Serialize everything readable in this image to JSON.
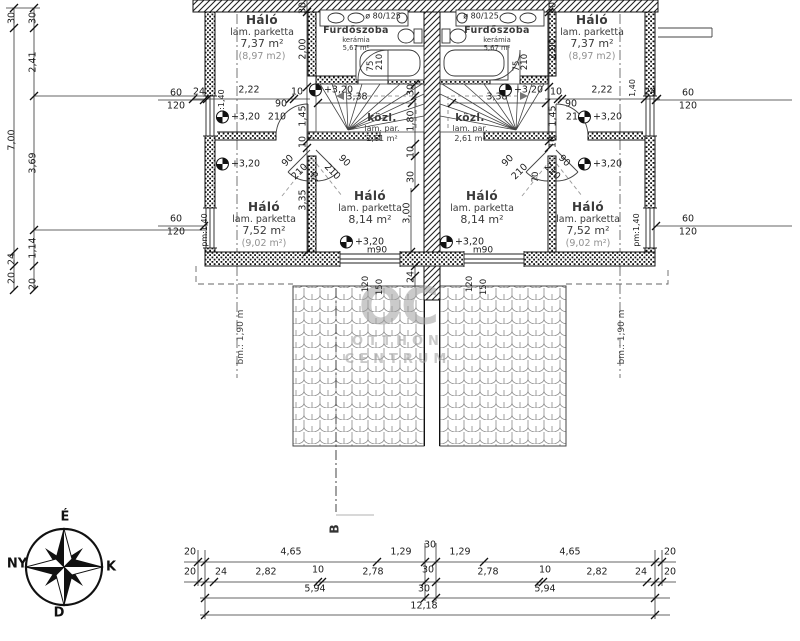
{
  "rooms": {
    "top_left": {
      "name": "Háló",
      "floor": "lam. parketta",
      "area": "7,37 m²",
      "area_alt": "(8,97 m2)"
    },
    "top_right": {
      "name": "Háló",
      "floor": "lam. parketta",
      "area": "7,37 m²",
      "area_alt": "(8,97 m2)"
    },
    "bath_left": {
      "name": "Fürdőszoba",
      "floor": "kerámia",
      "area": "5,67 m²"
    },
    "bath_right": {
      "name": "Fürdőszoba",
      "floor": "kerámia",
      "area": "5,67 m²"
    },
    "hall_left": {
      "name": "közl.",
      "floor": "lam. par.",
      "area": "2,61 m²"
    },
    "hall_right": {
      "name": "közl.",
      "floor": "lam. par.",
      "area": "2,61 m²"
    },
    "mid_left": {
      "name": "Háló",
      "floor": "lam. parketta",
      "area": "8,14 m²"
    },
    "mid_right": {
      "name": "Háló",
      "floor": "lam. parketta",
      "area": "8,14 m²"
    },
    "bottom_left": {
      "name": "Háló",
      "floor": "lam. parketta",
      "area": "7,52 m²",
      "area_alt": "(9,02 m²)"
    },
    "bottom_right": {
      "name": "Háló",
      "floor": "lam. parketta",
      "area": "7,52 m²",
      "area_alt": "(9,02 m²)"
    }
  },
  "fixtures": {
    "shower_left": "ø 80/125",
    "shower_right": "ø 80/125"
  },
  "levels": {
    "value": "+3,20",
    "markers": [
      {
        "x": 238,
        "y": 117
      },
      {
        "x": 600,
        "y": 117
      },
      {
        "x": 238,
        "y": 164
      },
      {
        "x": 600,
        "y": 164
      },
      {
        "x": 331,
        "y": 90
      },
      {
        "x": 521,
        "y": 90
      },
      {
        "x": 362,
        "y": 242
      },
      {
        "x": 462,
        "y": 242
      }
    ]
  },
  "roof": {
    "left_depth": "bm.: 1,90 m",
    "right_depth": "bm.: 1,90 m"
  },
  "section": {
    "label": "B"
  },
  "compass": {
    "north": "É",
    "west": "NY",
    "east": "K",
    "south": "D"
  },
  "watermark": {
    "line1": "OC",
    "line2": "OTTHON",
    "line3": "CENTRUM"
  },
  "dim_labels": [
    {
      "t": "30",
      "x": 12,
      "y": 18,
      "r": -90
    },
    {
      "t": "7,00",
      "x": 12,
      "y": 140,
      "r": -90
    },
    {
      "t": "24",
      "x": 12,
      "y": 259,
      "r": -90
    },
    {
      "t": "20",
      "x": 12,
      "y": 278,
      "r": -90
    },
    {
      "t": "30",
      "x": 33,
      "y": 18,
      "r": -90
    },
    {
      "t": "2,41",
      "x": 33,
      "y": 62,
      "r": -90
    },
    {
      "t": "3,69",
      "x": 33,
      "y": 163,
      "r": -90
    },
    {
      "t": "1,14",
      "x": 33,
      "y": 248,
      "r": -90
    },
    {
      "t": "20",
      "x": 33,
      "y": 284,
      "r": -90
    },
    {
      "t": "60",
      "x": 176,
      "y": 93
    },
    {
      "t": "120",
      "x": 176,
      "y": 106
    },
    {
      "t": "60",
      "x": 176,
      "y": 219
    },
    {
      "t": "120",
      "x": 176,
      "y": 232
    },
    {
      "t": "60",
      "x": 688,
      "y": 93
    },
    {
      "t": "120",
      "x": 688,
      "y": 106
    },
    {
      "t": "60",
      "x": 688,
      "y": 219
    },
    {
      "t": "120",
      "x": 688,
      "y": 232
    },
    {
      "t": "24",
      "x": 199,
      "y": 92
    },
    {
      "t": "2,22",
      "x": 249,
      "y": 90
    },
    {
      "t": "10",
      "x": 297,
      "y": 92
    },
    {
      "t": "90",
      "x": 281,
      "y": 104
    },
    {
      "t": "210",
      "x": 277,
      "y": 117
    },
    {
      "t": "pm:1,40",
      "x": 222,
      "y": 106,
      "r": -90,
      "fs": 8
    },
    {
      "t": "10",
      "x": 556,
      "y": 92
    },
    {
      "t": "2,22",
      "x": 602,
      "y": 90
    },
    {
      "t": "24",
      "x": 650,
      "y": 92
    },
    {
      "t": "90",
      "x": 571,
      "y": 104
    },
    {
      "t": "210",
      "x": 575,
      "y": 117
    },
    {
      "t": "1,40",
      "x": 633,
      "y": 88,
      "r": -90,
      "fs": 8
    },
    {
      "t": "pm:1,40",
      "x": 205,
      "y": 230,
      "r": -90,
      "fs": 8
    },
    {
      "t": "pm:1,40",
      "x": 637,
      "y": 230,
      "r": -90,
      "fs": 8
    },
    {
      "t": "30",
      "x": 303,
      "y": 8,
      "r": -90
    },
    {
      "t": "2,00",
      "x": 303,
      "y": 49,
      "r": -90
    },
    {
      "t": "1,45",
      "x": 303,
      "y": 116,
      "r": -90
    },
    {
      "t": "10",
      "x": 303,
      "y": 142,
      "r": -90
    },
    {
      "t": "30",
      "x": 553,
      "y": 8,
      "r": -90
    },
    {
      "t": "2,00",
      "x": 553,
      "y": 49,
      "r": -90
    },
    {
      "t": "1,45",
      "x": 553,
      "y": 116,
      "r": -90
    },
    {
      "t": "10",
      "x": 553,
      "y": 142,
      "r": -90
    },
    {
      "t": "75",
      "x": 371,
      "y": 66,
      "r": -90,
      "fs": 8.5
    },
    {
      "t": "210",
      "x": 380,
      "y": 62,
      "r": -90,
      "fs": 8.5
    },
    {
      "t": "210",
      "x": 525,
      "y": 62,
      "r": -90,
      "fs": 8.5
    },
    {
      "t": "75",
      "x": 517,
      "y": 66,
      "r": -90,
      "fs": 8.5
    },
    {
      "t": "3,38",
      "x": 357,
      "y": 97
    },
    {
      "t": "3,38",
      "x": 497,
      "y": 97
    },
    {
      "t": "30",
      "x": 411,
      "y": 90,
      "r": -90
    },
    {
      "t": "1,80",
      "x": 411,
      "y": 121,
      "r": -90
    },
    {
      "t": "10",
      "x": 411,
      "y": 152,
      "r": -90
    },
    {
      "t": "30",
      "x": 411,
      "y": 177,
      "r": -90
    },
    {
      "t": "24",
      "x": 411,
      "y": 277,
      "r": -90
    },
    {
      "t": "3,35",
      "x": 303,
      "y": 200,
      "r": -90
    },
    {
      "t": "3,00",
      "x": 407,
      "y": 213,
      "r": -90
    },
    {
      "t": "90",
      "x": 288,
      "y": 161,
      "r": -45
    },
    {
      "t": "210",
      "x": 300,
      "y": 172,
      "r": -45
    },
    {
      "t": "90",
      "x": 344,
      "y": 161,
      "r": 45
    },
    {
      "t": "210",
      "x": 332,
      "y": 172,
      "r": 45
    },
    {
      "t": "70",
      "x": 316,
      "y": 177,
      "r": -90,
      "fs": 8.5
    },
    {
      "t": "90",
      "x": 564,
      "y": 161,
      "r": 45
    },
    {
      "t": "210",
      "x": 552,
      "y": 172,
      "r": 45
    },
    {
      "t": "90",
      "x": 508,
      "y": 161,
      "r": -45
    },
    {
      "t": "210",
      "x": 520,
      "y": 172,
      "r": -45
    },
    {
      "t": "70",
      "x": 536,
      "y": 177,
      "r": -90,
      "fs": 8.5
    },
    {
      "t": "120",
      "x": 366,
      "y": 284,
      "r": -90,
      "fs": 8.5
    },
    {
      "t": "150",
      "x": 380,
      "y": 287,
      "r": -90,
      "fs": 8.5
    },
    {
      "t": "120",
      "x": 470,
      "y": 284,
      "r": -90,
      "fs": 8.5
    },
    {
      "t": "150",
      "x": 484,
      "y": 287,
      "r": -90,
      "fs": 8.5
    },
    {
      "t": "m90",
      "x": 377,
      "y": 251,
      "fs": 9
    },
    {
      "t": "m90",
      "x": 483,
      "y": 251,
      "fs": 9
    },
    {
      "t": "20",
      "x": 190,
      "y": 552
    },
    {
      "t": "4,65",
      "x": 291,
      "y": 552
    },
    {
      "t": "1,29",
      "x": 401,
      "y": 552
    },
    {
      "t": "30",
      "x": 430,
      "y": 545
    },
    {
      "t": "1,29",
      "x": 460,
      "y": 552
    },
    {
      "t": "4,65",
      "x": 570,
      "y": 552
    },
    {
      "t": "20",
      "x": 670,
      "y": 552
    },
    {
      "t": "20",
      "x": 190,
      "y": 572
    },
    {
      "t": "24",
      "x": 221,
      "y": 572
    },
    {
      "t": "2,82",
      "x": 266,
      "y": 572
    },
    {
      "t": "10",
      "x": 318,
      "y": 570
    },
    {
      "t": "2,78",
      "x": 373,
      "y": 572
    },
    {
      "t": "30",
      "x": 428,
      "y": 570
    },
    {
      "t": "2,78",
      "x": 488,
      "y": 572
    },
    {
      "t": "10",
      "x": 545,
      "y": 570
    },
    {
      "t": "2,82",
      "x": 597,
      "y": 572
    },
    {
      "t": "24",
      "x": 641,
      "y": 572
    },
    {
      "t": "20",
      "x": 670,
      "y": 572
    },
    {
      "t": "5,94",
      "x": 315,
      "y": 589
    },
    {
      "t": "30",
      "x": 424,
      "y": 589
    },
    {
      "t": "5,94",
      "x": 545,
      "y": 589
    },
    {
      "t": "12,18",
      "x": 424,
      "y": 606,
      "n": "dim-total-width"
    }
  ]
}
